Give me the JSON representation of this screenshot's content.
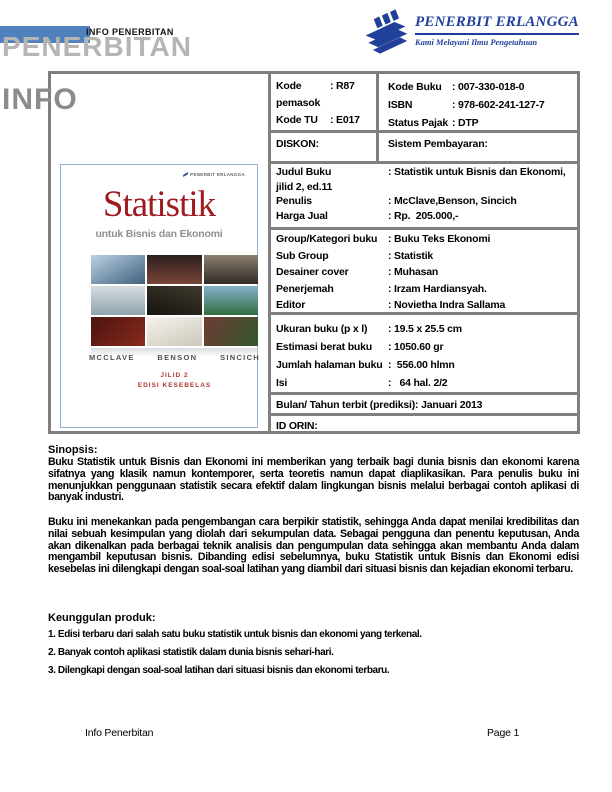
{
  "colors": {
    "accent": "#4f81bd",
    "border-gray": "#7f7f7f",
    "watermark-light": "#b5b5b5",
    "watermark-dark": "#8c8c8c",
    "logo-blue": "#21409a",
    "cover-title-red": "#9e1b20",
    "cover-edition-red": "#b23530",
    "cover-border-blue": "#8fb1d8"
  },
  "header": {
    "small_title": "INFO PENERBITAN",
    "watermark_top": "PENERBITAN",
    "watermark_bottom": "INFO",
    "logo_name": "PENERBIT ERLANGGA",
    "logo_tagline": "Kami Melayani Ilmu Pengetahuan"
  },
  "table": {
    "codes_left": [
      {
        "label": "Kode pemasok",
        "value": ": R87"
      },
      {
        "label": "Kode TU",
        "value": ": E017"
      }
    ],
    "codes_right": [
      {
        "label": "Kode Buku",
        "value": ": 007-330-018-0"
      },
      {
        "label": "ISBN",
        "value": ": 978-602-241-127-7"
      },
      {
        "label": "Status Pajak",
        "value": ": DTP"
      }
    ],
    "diskon_label": "DISKON:",
    "pembayaran_label": "Sistem Pembayaran:",
    "judul_rows": [
      {
        "label": "Judul Buku",
        "value": ": Statistik untuk Bisnis dan Ekonomi,"
      },
      {
        "label": "jilid 2, ed.11",
        "value": ""
      },
      {
        "label": "Penulis",
        "value": ": McClave,Benson, Sincich"
      },
      {
        "label": "Harga Jual",
        "value": ": Rp.  205.000,-"
      }
    ],
    "group_rows": [
      {
        "label": "Group/Kategori buku",
        "value": ": Buku Teks Ekonomi"
      },
      {
        "label": "Sub Group",
        "value": ": Statistik"
      },
      {
        "label": "Desainer cover",
        "value": ": Muhasan"
      },
      {
        "label": "Penerjemah",
        "value": ": Irzam Hardiansyah."
      },
      {
        "label": "Editor",
        "value": ": Novietha Indra Sallama"
      }
    ],
    "ukuran_rows": [
      {
        "label": "Ukuran buku (p x l)",
        "value": ": 19.5 x 25.5 cm"
      },
      {
        "label": "Estimasi berat buku",
        "value": ": 1050.60 gr"
      },
      {
        "label": "Jumlah halaman buku",
        "value": ":  556.00 hlmn"
      },
      {
        "label": "Isi",
        "value": ":   64 hal. 2/2"
      }
    ],
    "bulan_label": "Bulan/ Tahun terbit (prediksi): Januari 2013",
    "idorin_label": "ID ORIN:"
  },
  "cover": {
    "publisher": "PENERBIT ERLANGGA",
    "title": "Statistik",
    "subtitle": "untuk Bisnis dan Ekonomi",
    "authors": [
      "MCCLAVE",
      "BENSON",
      "SINCICH"
    ],
    "edition_line1": "JILID 2",
    "edition_line2": "EDISI KESEBELAS",
    "photo_tiles": [
      {
        "angle": 150,
        "from": "#b9d2e4",
        "to": "#41607c"
      },
      {
        "angle": 180,
        "from": "#2b1f1e",
        "to": "#7a4538"
      },
      {
        "angle": 180,
        "from": "#8c8070",
        "to": "#2f2a24"
      },
      {
        "angle": 180,
        "from": "#d6dde0",
        "to": "#90a4ae"
      },
      {
        "angle": 200,
        "from": "#403a2e",
        "to": "#16140f"
      },
      {
        "angle": 180,
        "from": "#86afcb",
        "to": "#2f6e41"
      },
      {
        "angle": 135,
        "from": "#4a1410",
        "to": "#8a2a1c"
      },
      {
        "angle": 160,
        "from": "#f4f2ec",
        "to": "#cdc8ba"
      },
      {
        "angle": 120,
        "from": "#6e3a33",
        "to": "#33582f"
      }
    ]
  },
  "sinopsis": {
    "heading": "Sinopsis:",
    "paragraphs": [
      "Buku Statistik untuk Bisnis dan Ekonomi ini memberikan yang terbaik bagi dunia bisnis dan ekonomi karena sifatnya yang klasik namun kontemporer, serta teoretis namun dapat diaplikasikan. Para penulis buku ini menunjukkan penggunaan statistik secara efektif dalam lingkungan bisnis melalui berbagai contoh aplikasi di banyak industri.",
      "Buku ini menekankan pada pengembangan cara berpikir statistik, sehingga Anda dapat menilai kredibilitas dan nilai sebuah kesimpulan yang diolah dari sekumpulan data. Sebagai pengguna dan penentu keputusan, Anda akan dikenalkan pada berbagai teknik analisis dan pengumpulan data sehingga akan membantu Anda dalam mengambil keputusan bisnis. Dibanding edisi sebelumnya, buku Statistik untuk Bisnis dan Ekonomi edisi kesebelas ini dilengkapi dengan soal-soal latihan yang diambil dari situasi bisnis dan kejadian ekonomi terbaru."
    ]
  },
  "keunggulan": {
    "heading": "Keunggulan produk:",
    "items": [
      "1. Edisi terbaru dari salah satu buku statistik untuk bisnis dan ekonomi yang terkenal.",
      "2. Banyak contoh aplikasi statistik dalam dunia bisnis sehari-hari.",
      "3. Dilengkapi dengan soal-soal latihan dari situasi bisnis dan ekonomi terbaru."
    ]
  },
  "footer": {
    "left": "Info Penerbitan",
    "right": "Page 1"
  }
}
